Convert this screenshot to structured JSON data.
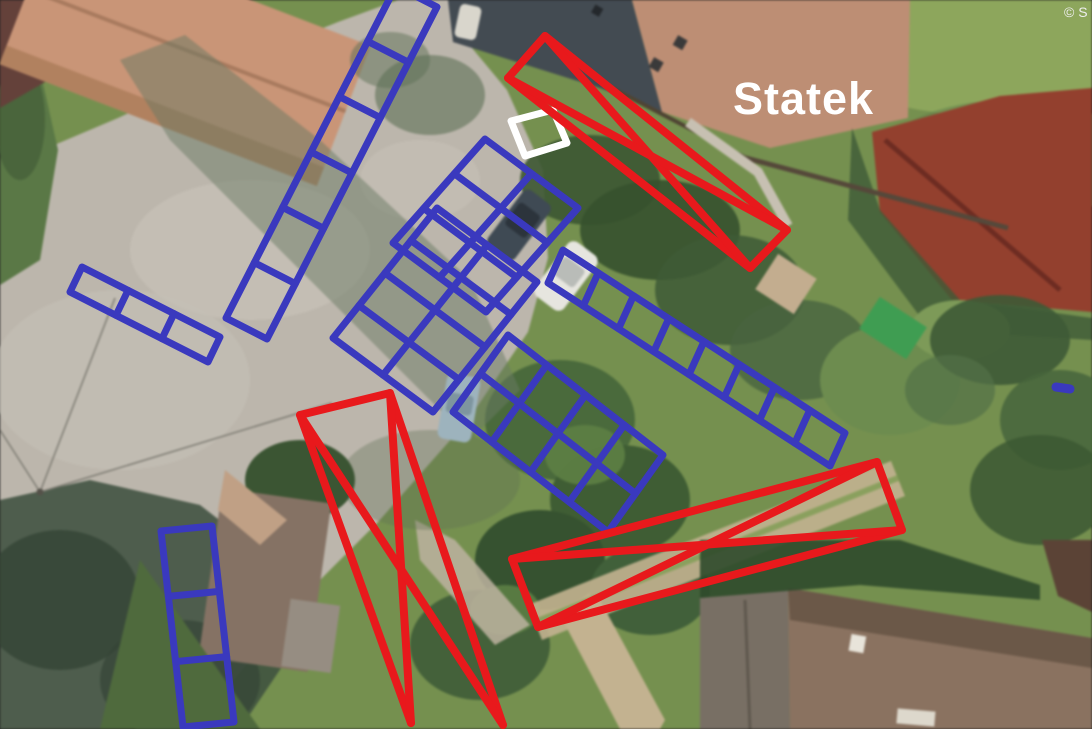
{
  "map": {
    "label": "Statek",
    "label_color": "#ffffff",
    "copyright": "© S",
    "annotation_colors": {
      "blue": "#3a39be",
      "red": "#e8191c",
      "white": "#ffffff"
    },
    "stroke_widths": {
      "blue": 7,
      "red": 8,
      "white": 7
    },
    "annotations": {
      "grids": [
        {
          "id": "blue-ladder-top-left",
          "color_key": "blue",
          "origin": [
            396,
            -14
          ],
          "u": [
            41,
            21
          ],
          "cols": 1,
          "v": [
            -170,
            332
          ],
          "rows": 6
        },
        {
          "id": "blue-ladder-left",
          "color_key": "blue",
          "origin": [
            82,
            267
          ],
          "u": [
            138,
            70
          ],
          "cols": 3,
          "v": [
            -12,
            25
          ],
          "rows": 1
        },
        {
          "id": "blue-grid-upper-center",
          "color_key": "blue",
          "origin": [
            485,
            139
          ],
          "u": [
            93,
            69
          ],
          "cols": 2,
          "v": [
            -92,
            104
          ],
          "rows": 3
        },
        {
          "id": "blue-grid-center",
          "color_key": "blue",
          "origin": [
            437,
            208
          ],
          "u": [
            100,
            74
          ],
          "cols": 2,
          "v": [
            -104,
            130
          ],
          "rows": 4
        },
        {
          "id": "blue-grid-lower-center",
          "color_key": "blue",
          "origin": [
            508,
            335
          ],
          "u": [
            155,
            120
          ],
          "cols": 4,
          "v": [
            -55,
            77
          ],
          "rows": 2
        },
        {
          "id": "blue-ladder-right",
          "color_key": "blue",
          "origin": [
            563,
            250
          ],
          "u": [
            282,
            183
          ],
          "cols": 8,
          "v": [
            -15,
            33
          ],
          "rows": 1
        },
        {
          "id": "blue-ladder-bottom-left",
          "color_key": "blue",
          "origin": [
            161,
            531
          ],
          "u": [
            51,
            -5
          ],
          "cols": 1,
          "v": [
            22,
            196
          ],
          "rows": 3
        }
      ],
      "boxes": [
        {
          "id": "white-box",
          "color_key": "white",
          "closed": true,
          "diagonals": false,
          "points": [
            [
              511,
              121
            ],
            [
              553,
              110
            ],
            [
              567,
              143
            ],
            [
              525,
              156
            ]
          ]
        },
        {
          "id": "red-cross-box-top",
          "color_key": "red",
          "closed": true,
          "diagonals": true,
          "points": [
            [
              545,
              36
            ],
            [
              787,
              230
            ],
            [
              750,
              268
            ],
            [
              508,
              78
            ]
          ]
        },
        {
          "id": "red-cross-box-bottom",
          "color_key": "red",
          "closed": true,
          "diagonals": true,
          "points": [
            [
              877,
              462
            ],
            [
              902,
              530
            ],
            [
              538,
              627
            ],
            [
              512,
              559
            ]
          ]
        },
        {
          "id": "red-cross-shape-left",
          "color_key": "red",
          "closed": false,
          "diagonals": true,
          "points": [
            [
              411,
              723
            ],
            [
              300,
              415
            ],
            [
              390,
              393
            ],
            [
              503,
              725
            ]
          ]
        }
      ],
      "marks": [
        {
          "id": "blue-dash-right-edge",
          "color_key": "blue",
          "from": [
            1056,
            387
          ],
          "to": [
            1070,
            389
          ],
          "width": 9
        }
      ]
    }
  }
}
